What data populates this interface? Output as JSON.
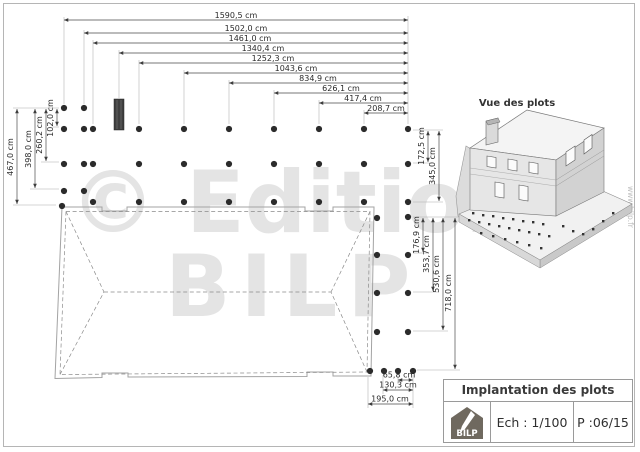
{
  "watermark": {
    "line1": "© Editions",
    "line2": "BILP",
    "site": "www.bilp.fr"
  },
  "plan": {
    "top_dims": [
      "1590,5 cm",
      "1502,0 cm",
      "1461,0 cm",
      "1340,4 cm",
      "1252,3 cm",
      "1043,6 cm",
      "834,9 cm",
      "626,1 cm",
      "417,4 cm",
      "208,7 cm"
    ],
    "left_dims": [
      "467,0 cm",
      "398,0 cm",
      "260,2 cm",
      "102,0 cm"
    ],
    "right_top_dims": [
      "172,5 cm",
      "345,0 cm"
    ],
    "right_bottom_dims": [
      "176,9 cm",
      "353,7 cm",
      "530,6 cm",
      "718,0 cm"
    ],
    "bottom_dims": [
      "65,8 cm",
      "130,3 cm",
      "195,0 cm"
    ],
    "plots": [
      [
        64,
        108
      ],
      [
        84,
        108
      ],
      [
        64,
        129
      ],
      [
        84,
        129
      ],
      [
        93,
        129
      ],
      [
        139,
        129
      ],
      [
        184,
        129
      ],
      [
        229,
        129
      ],
      [
        274,
        129
      ],
      [
        319,
        129
      ],
      [
        364,
        129
      ],
      [
        408,
        129
      ],
      [
        64,
        164
      ],
      [
        84,
        164
      ],
      [
        93,
        164
      ],
      [
        139,
        164
      ],
      [
        184,
        164
      ],
      [
        229,
        164
      ],
      [
        274,
        164
      ],
      [
        319,
        164
      ],
      [
        364,
        164
      ],
      [
        408,
        164
      ],
      [
        64,
        191
      ],
      [
        84,
        191
      ],
      [
        93,
        202
      ],
      [
        139,
        202
      ],
      [
        184,
        202
      ],
      [
        229,
        202
      ],
      [
        274,
        202
      ],
      [
        319,
        202
      ],
      [
        364,
        202
      ],
      [
        408,
        202
      ],
      [
        62,
        206
      ],
      [
        377,
        218
      ],
      [
        377,
        255
      ],
      [
        377,
        293
      ],
      [
        377,
        332
      ],
      [
        408,
        217
      ],
      [
        408,
        255
      ],
      [
        408,
        293
      ],
      [
        408,
        332
      ],
      [
        370,
        371
      ],
      [
        384,
        371
      ],
      [
        398,
        371
      ],
      [
        413,
        371
      ]
    ]
  },
  "view3d": {
    "title": "Vue des plots",
    "ground_plots": [
      [
        472,
        212
      ],
      [
        482,
        214
      ],
      [
        492,
        215
      ],
      [
        502,
        217
      ],
      [
        512,
        218
      ],
      [
        522,
        220
      ],
      [
        532,
        221
      ],
      [
        542,
        223
      ],
      [
        468,
        219
      ],
      [
        478,
        221
      ],
      [
        488,
        223
      ],
      [
        498,
        225
      ],
      [
        508,
        227
      ],
      [
        518,
        229
      ],
      [
        528,
        231
      ],
      [
        538,
        233
      ],
      [
        548,
        235
      ],
      [
        480,
        232
      ],
      [
        492,
        235
      ],
      [
        504,
        238
      ],
      [
        516,
        241
      ],
      [
        528,
        244
      ],
      [
        540,
        247
      ],
      [
        562,
        225
      ],
      [
        572,
        230
      ],
      [
        582,
        233
      ],
      [
        592,
        228
      ],
      [
        602,
        220
      ],
      [
        612,
        212
      ]
    ]
  },
  "title_block": {
    "title": "Implantation des plots",
    "scale": "Ech : 1/100",
    "page": "P :06/15",
    "logo_text": "BILP"
  },
  "colors": {
    "plot_dot": "#2b2b2b",
    "watermark": "#e4e4e4",
    "outline": "#a3a3a3",
    "logo_bg": "#6f695f"
  }
}
